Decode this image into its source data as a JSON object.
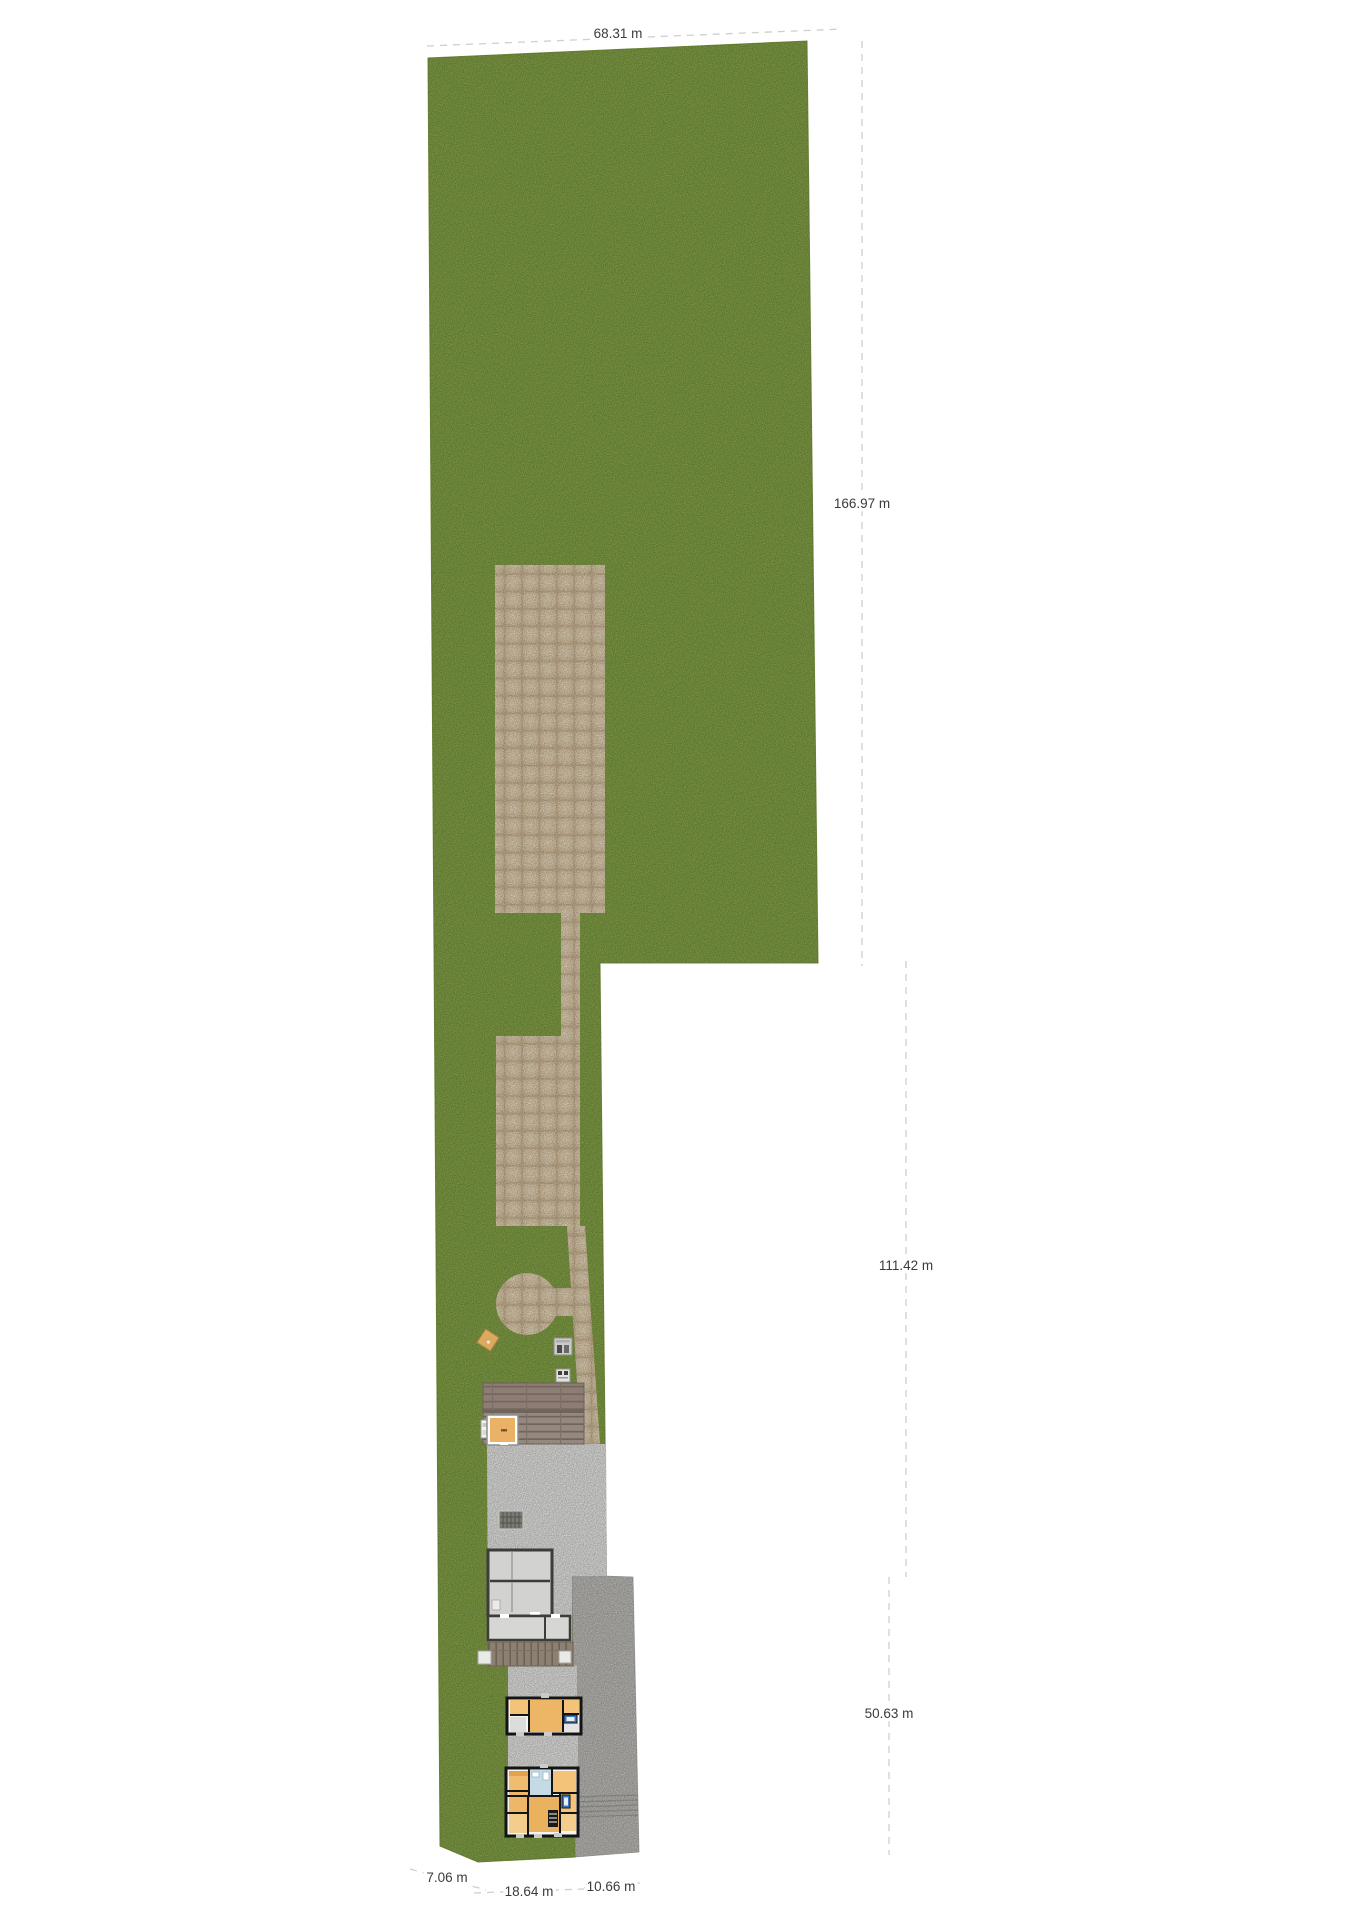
{
  "plan": {
    "dimension_labels": {
      "top_width": "68.31 m",
      "right_upper": "166.97 m",
      "right_middle": "111.42 m",
      "right_lower": "50.63 m",
      "bottom_left": "7.06 m",
      "bottom_center": "18.64 m",
      "bottom_right": "10.66 m"
    },
    "colors": {
      "grass": "#7d9a43",
      "paver": "#d2c0a3",
      "concrete": "#d9d9d7",
      "cobble_strip": "#b4b3af",
      "roof": "#8f8379",
      "deck": "#897d6e",
      "wall": "#1b1b1b",
      "floor_orange": "#eab266",
      "floor_blue": "#c4dae5",
      "floor_gray": "#d8d8d6",
      "dimension_text": "#3b3b3b",
      "dimension_line": "#cfcfcd"
    }
  }
}
